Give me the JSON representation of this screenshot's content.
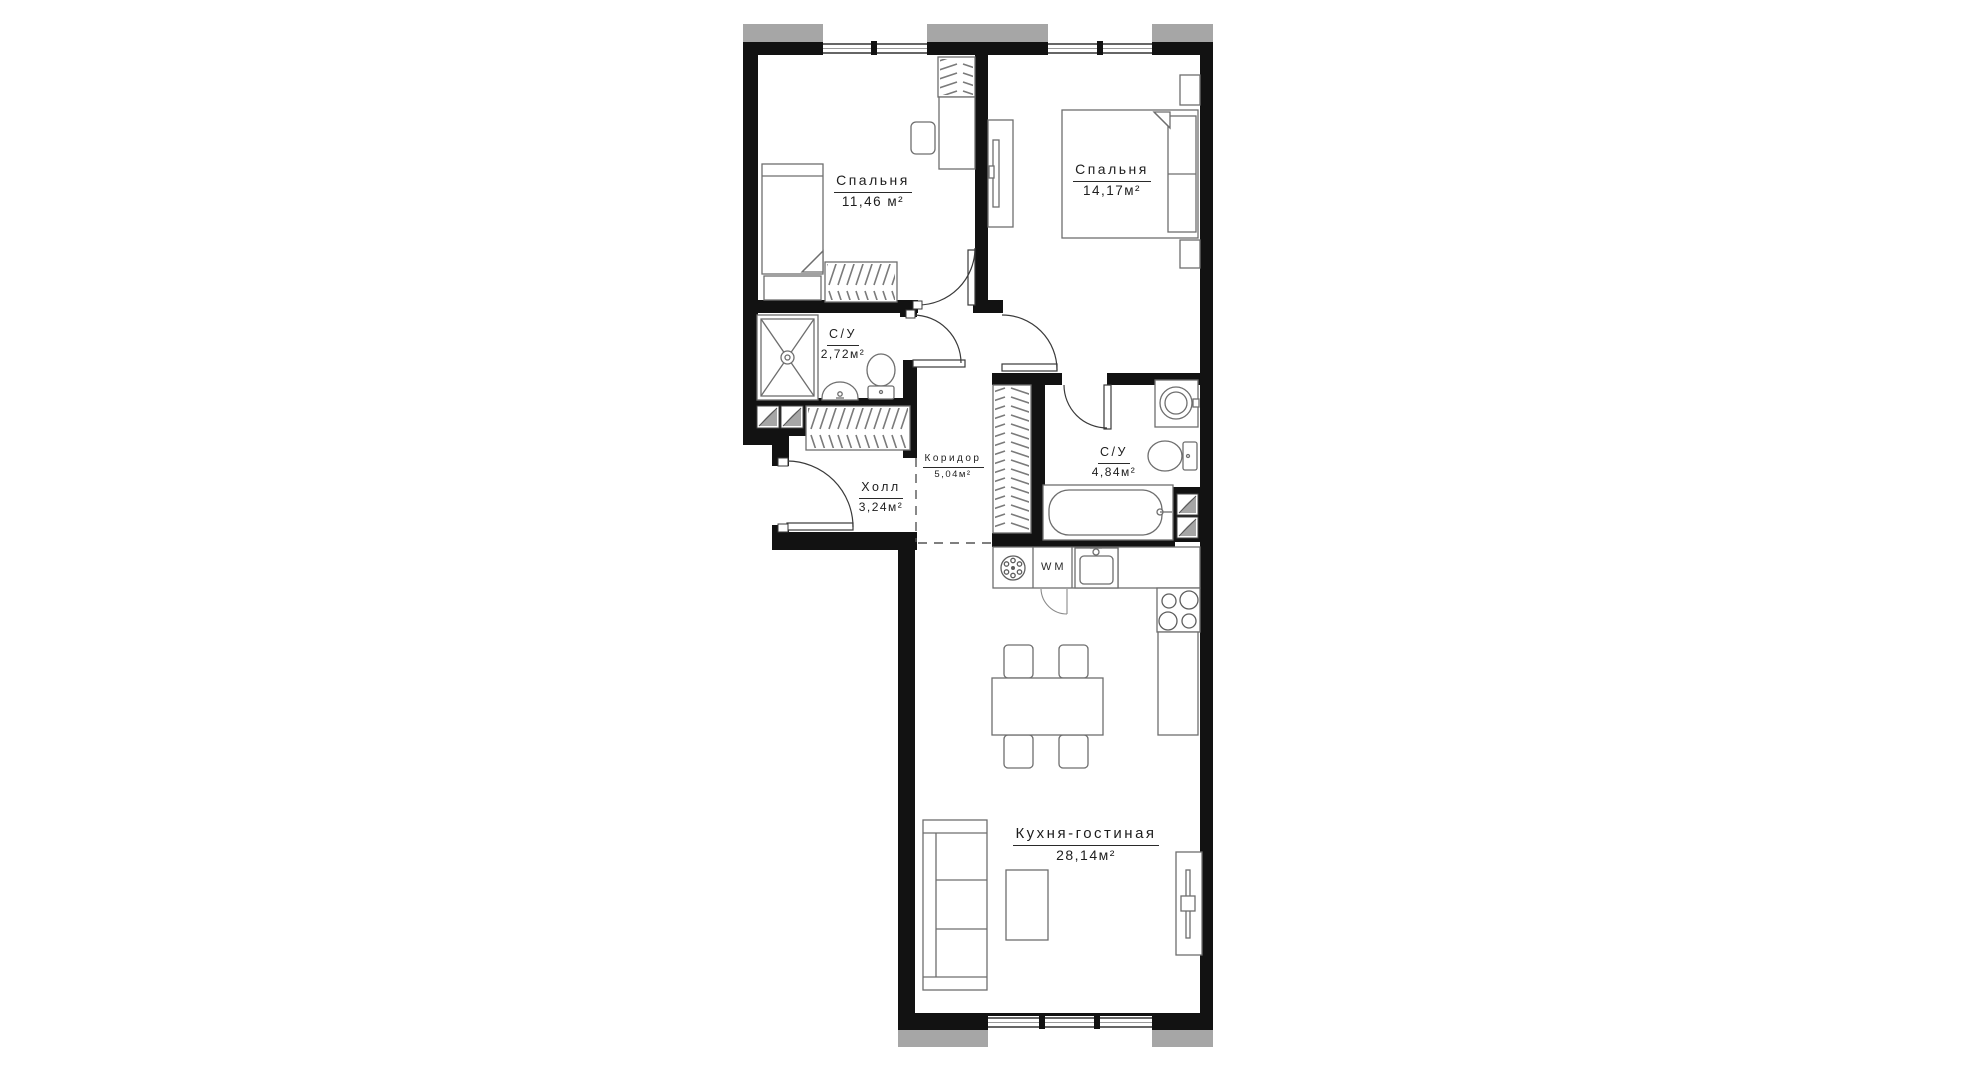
{
  "floor_plan": {
    "rooms": [
      {
        "id": "bedroom-1",
        "name": "Спальня",
        "area": "11,46 м²"
      },
      {
        "id": "bedroom-2",
        "name": "Спальня",
        "area": "14,17м²"
      },
      {
        "id": "bathroom-1",
        "name": "С/У",
        "area": "2,72м²"
      },
      {
        "id": "hall",
        "name": "Холл",
        "area": "3,24м²"
      },
      {
        "id": "corridor",
        "name": "Коридор",
        "area": "5,04м²"
      },
      {
        "id": "bathroom-2",
        "name": "С/У",
        "area": "4,84м²"
      },
      {
        "id": "kitchen-living",
        "name": "Кухня-гостиная",
        "area": "28,14м²"
      }
    ],
    "appliance_labels": {
      "washing_machine": "WM"
    },
    "colors": {
      "wall": "#121212",
      "exterior_pier": "#a6a6a6",
      "furniture_line": "#6e6e6e",
      "dashed_line": "#555555",
      "text": "#1d1d1d",
      "background": "#ffffff"
    }
  }
}
